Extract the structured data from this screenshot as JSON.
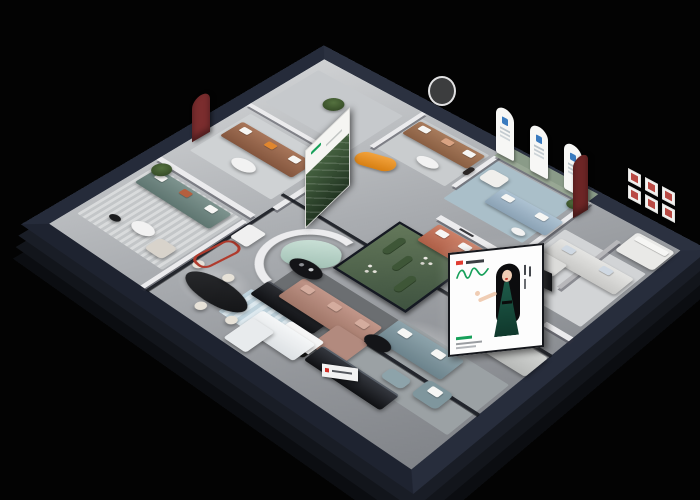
{
  "image": {
    "kind": "3D isometric cutaway render of a furniture showroom floor plan",
    "background": "#030303"
  },
  "building": {
    "outer_wall_color": "#272d3c",
    "slab_side_color": "#12151b",
    "floor_color": "#aaadb1",
    "inner_wall_color": "#ebebed",
    "glass_frame_color": "#12151c",
    "glass_rails_label": "Dark framed glass partitions"
  },
  "rooms": {
    "west_lounge": {
      "label": "West lounge — teal sofa display",
      "items": [
        {
          "label": "Teal three-seat sofa",
          "color": "#6f8a84"
        },
        {
          "label": "Tall potted plant",
          "color": "#3f5a35"
        },
        {
          "label": "Round white coffee table",
          "color": "#f2f2f2"
        },
        {
          "label": "Cream armchair",
          "color": "#d8d3cb"
        },
        {
          "label": "Striped area rug",
          "color": "#d9dbdc"
        }
      ]
    },
    "northwest_lounge": {
      "label": "Northwest lounge — brown leather sofa display",
      "items": [
        {
          "label": "Brown leather sofa",
          "color": "#9a6a4e"
        },
        {
          "label": "Dark red arched wall niche",
          "color": "#7b2d2e"
        },
        {
          "label": "Forest artwork poster",
          "color": "#2e4632"
        },
        {
          "label": "White oval coffee table",
          "color": "#f2f2f2"
        },
        {
          "label": "Black sideboard",
          "color": "#17181c"
        },
        {
          "label": "Black floor lamp",
          "color": "#141414"
        }
      ]
    },
    "north_gallery": {
      "label": "North corner gallery",
      "items": [
        {
          "label": "Potted tree",
          "color": "#3f5a35"
        }
      ]
    },
    "north_bay": {
      "label": "North bay — caramel sofa display",
      "items": [
        {
          "label": "Caramel leather sofa",
          "color": "#9a7153"
        },
        {
          "label": "Orange curved chaise",
          "color": "#e8921f"
        },
        {
          "label": "Bronze figurine on pedestal",
          "color": "#2a2524"
        },
        {
          "label": "White coffee table",
          "color": "#f2f2f2"
        },
        {
          "label": "Round wall mirror",
          "color": "#ffffff"
        }
      ]
    },
    "arch_gallery": {
      "label": "Arch gallery — sage wall with arched banners",
      "wall_color": "#8a9b88",
      "items": [
        {
          "label": "Three white arched banners with blue logos",
          "color": "#f7f7f5"
        },
        {
          "label": "White armchair",
          "color": "#f0efec"
        },
        {
          "label": "Light blue fabric sofa",
          "color": "#9fb4c6"
        },
        {
          "label": "Potted plant",
          "color": "#3f5a35"
        },
        {
          "label": "White side table",
          "color": "#f2f2f2"
        }
      ]
    },
    "east_suite": {
      "label": "East display suite",
      "items": [
        {
          "label": "Red framed prints, 3 by 2 grid",
          "color": "#b94a44"
        },
        {
          "label": "Dark red arched niche",
          "color": "#6e2626"
        },
        {
          "label": "White sectional sofa",
          "color": "#dcdcda"
        },
        {
          "label": "White chaise module",
          "color": "#dcdcda"
        },
        {
          "label": "White bed display",
          "color": "#e9e9e7"
        },
        {
          "label": "Black bistro table with cream chairs",
          "color": "#232428"
        },
        {
          "label": "Black brand shelf with red logo",
          "color": "#0c0d10"
        },
        {
          "label": "Light grey sofa",
          "color": "#c9cbc9"
        }
      ]
    },
    "center": {
      "label": "Central displays",
      "items": [
        {
          "label": "Glass cactus garden",
          "color": "#52684c"
        },
        {
          "label": "Rose sectional sofa",
          "color": "#b28a7e"
        },
        {
          "label": "Rose chaise module",
          "color": "#b28a7e"
        },
        {
          "label": "Black and white coffee table",
          "color": "#f5f5f5"
        },
        {
          "label": "Mint curved sofa",
          "color": "#bcd6cc"
        },
        {
          "label": "Black oval coffee table with vases",
          "color": "#131417"
        },
        {
          "label": "Terracotta sofa with white cushions",
          "color": "#c0745a"
        },
        {
          "label": "White curved partition wall",
          "color": "#ececee"
        },
        {
          "label": "Dark brand mark on white partition",
          "color": "#3a3a3e"
        }
      ]
    },
    "south_lounge": {
      "label": "South lounge — blue-grey leather set",
      "items": [
        {
          "label": "Blue-grey leather sofa",
          "color": "#7f969d"
        },
        {
          "label": "Blue-grey armchair",
          "color": "#7f969d"
        },
        {
          "label": "Blue-grey ottoman",
          "color": "#8da3aa"
        },
        {
          "label": "Black round coffee table",
          "color": "#141518"
        }
      ]
    },
    "south_retail": {
      "label": "South retail and dining zone",
      "items": [
        {
          "label": "Black oval dining table",
          "color": "#1b1c1e"
        },
        {
          "label": "Cream dining chairs",
          "color": "#e7e2d8"
        },
        {
          "label": "Red tubular display stand",
          "color": "#b03a2c"
        },
        {
          "label": "White shelving cabinet",
          "color": "#f0f0f0"
        },
        {
          "label": "White service counter",
          "color": "#edeff0"
        },
        {
          "label": "Black media bench",
          "color": "#0f1013"
        },
        {
          "label": "Blue mosaic rug",
          "color": "#b5cad4"
        },
        {
          "label": "White wall sign with red logo",
          "color": "#f2f2f2"
        }
      ]
    }
  },
  "billboard": {
    "label": "Illuminated brand billboard",
    "background": "#fdfdfd",
    "logo_color": "#17a05a",
    "accent_color": "#e03c31",
    "subject": "Illustrated woman with long black hair in dark green evening dress",
    "dress_color": "#14473a"
  },
  "signs": {
    "arch_banner_logo_color": "#3a7bbf",
    "shelf_logo_color": "#d22f27",
    "small_sign_logo_color": "#d22f27"
  }
}
